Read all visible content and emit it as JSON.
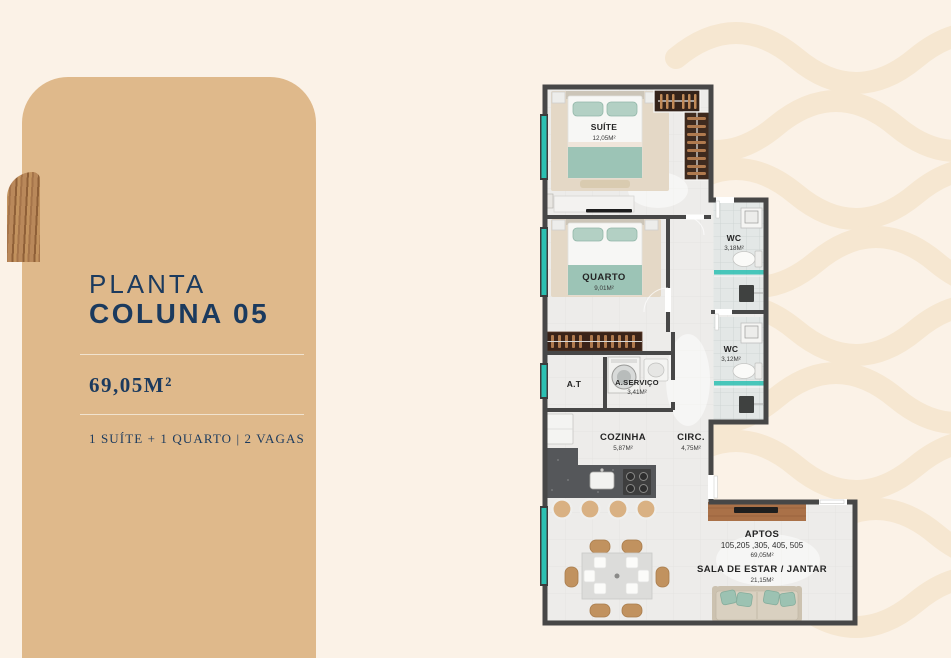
{
  "panel": {
    "title_line1": "PLANTA",
    "title_line2": "COLUNA 05",
    "area": "69,05M²",
    "features": "1 SUÍTE + 1 QUARTO | 2 VAGAS"
  },
  "floorplan": {
    "suite": {
      "name": "SUÍTE",
      "area": "12,05M²"
    },
    "quarto": {
      "name": "QUARTO",
      "area": "9,01M²"
    },
    "wc1": {
      "name": "WC",
      "area": "3,18M²"
    },
    "wc2": {
      "name": "WC",
      "area": "3,12M²"
    },
    "at": {
      "name": "A.T"
    },
    "servico": {
      "name": "A.SERVIÇO",
      "area": "3,41M²"
    },
    "cozinha": {
      "name": "COZINHA",
      "area": "5,87M²"
    },
    "circ": {
      "name": "CIRC.",
      "area": "4,75M²"
    },
    "aptos": {
      "label": "APTOS",
      "units": "105,205 ,305, 405, 505",
      "area": "69,05M²"
    },
    "sala": {
      "name": "SALA DE ESTAR / JANTAR",
      "area": "21,15M²"
    }
  },
  "colors": {
    "background": "#FBF2E7",
    "wave": "#F6E7D1",
    "card": "#DFB98B",
    "navy_text": "#1B3A5E",
    "window_teal": "#2BC0B2",
    "furniture_teal": "#9CC4B6",
    "wall": "#474747",
    "wood": "#A9714A"
  }
}
